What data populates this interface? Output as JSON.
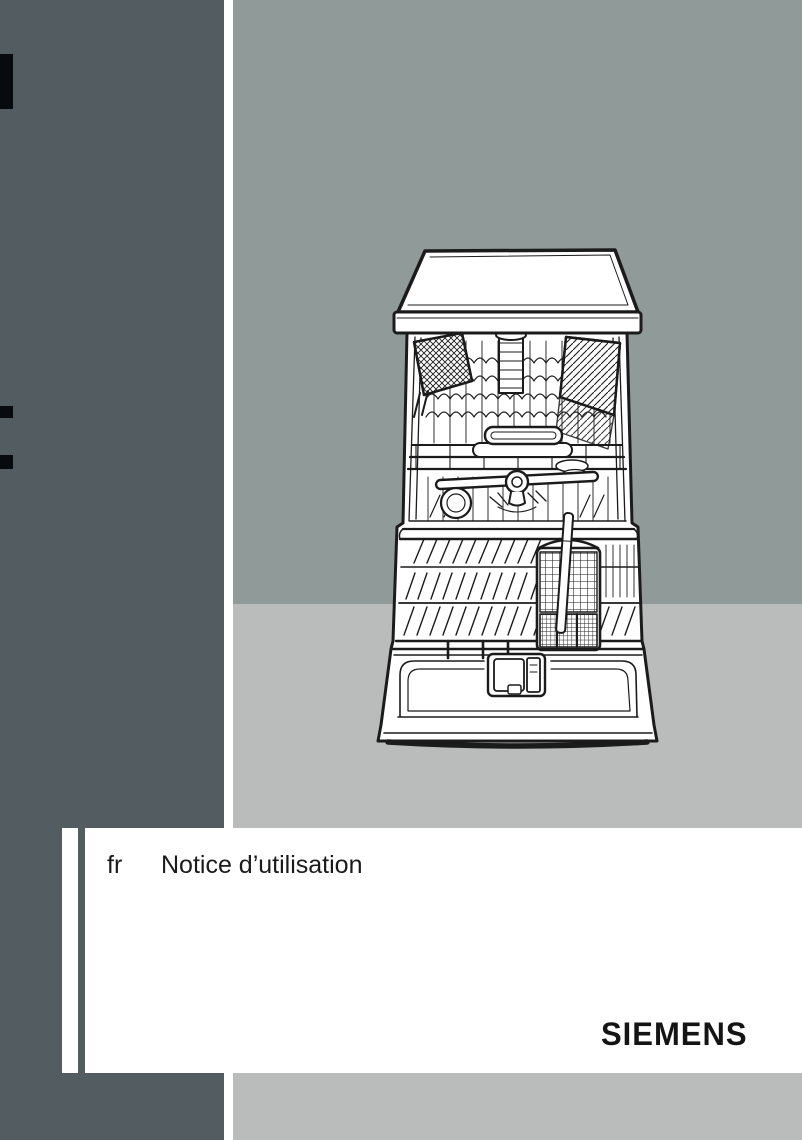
{
  "page": {
    "width": 802,
    "height": 1140,
    "kind": "manual-cover"
  },
  "colors": {
    "sidebar_dark": "#535c60",
    "backdrop_top": "#909a99",
    "backdrop_bottom": "#b9bcba",
    "page_white": "#ffffff",
    "crop_mark": "#070b0d",
    "line_art": "#1b1b1b"
  },
  "cover": {
    "language_code": "fr",
    "title": "Notice d’utilisation",
    "brand": "SIEMENS"
  },
  "illustration": {
    "name": "dishwasher-line-drawing"
  }
}
